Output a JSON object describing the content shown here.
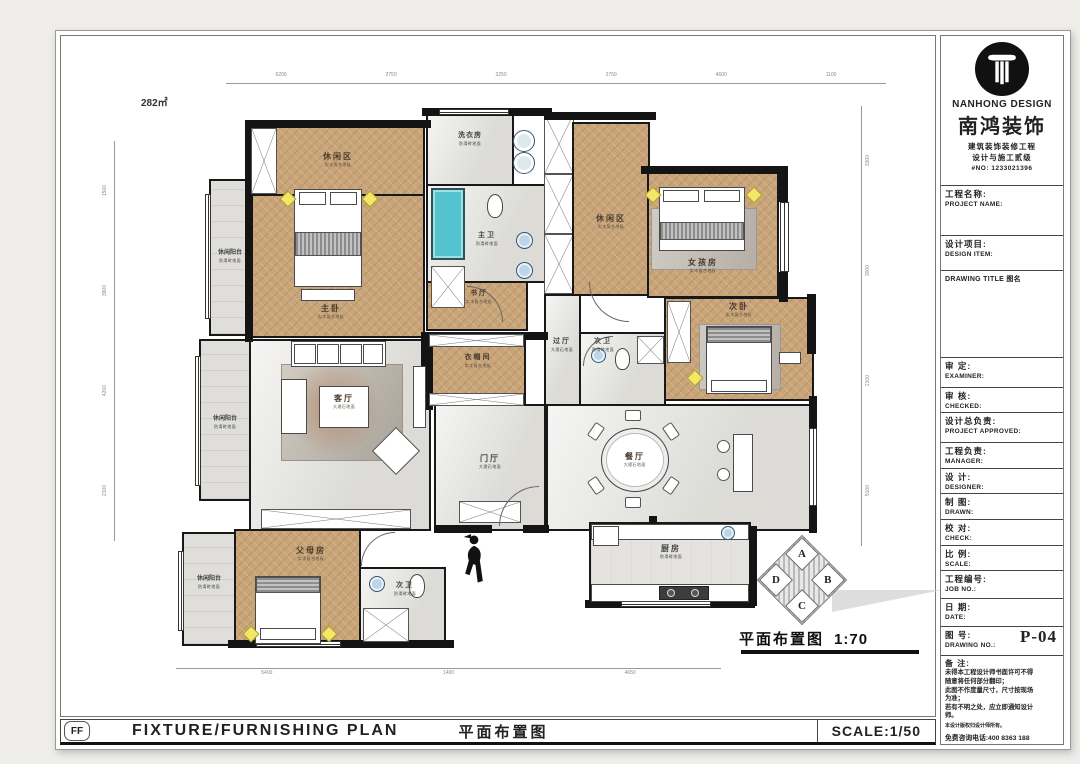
{
  "page": {
    "area_label": "282㎡",
    "caption": {
      "title": "平面布置图",
      "scale": "1:70"
    },
    "compass": {
      "top": "A",
      "right": "B",
      "bottom": "C",
      "left": "D"
    }
  },
  "rooms": {
    "leisure_tl": {
      "name": "休闲区",
      "sub": "实木复合地板"
    },
    "master": {
      "name": "主卧",
      "sub": "实木复合地板"
    },
    "balcony_tl": {
      "name": "休闲阳台",
      "sub": "防滑砖地面"
    },
    "laundry": {
      "name": "洗衣房",
      "sub": "防滑砖地面"
    },
    "master_bath": {
      "name": "主卫",
      "sub": "防滑砖地面"
    },
    "study_hall": {
      "name": "书厅",
      "sub": "实木复合地板"
    },
    "leisure_tr": {
      "name": "休闲区",
      "sub": "实木复合地板"
    },
    "girl": {
      "name": "女孩房",
      "sub": "实木复合地板"
    },
    "second": {
      "name": "次卧",
      "sub": "实木复合地板"
    },
    "bath_mid": {
      "name": "次卫",
      "sub": "防滑砖地面"
    },
    "hall": {
      "name": "过厅",
      "sub": "大理石地面"
    },
    "cloak": {
      "name": "衣帽间",
      "sub": "实木复合地板"
    },
    "living": {
      "name": "客厅",
      "sub": "大理石地面"
    },
    "balcony_ml": {
      "name": "休闲阳台",
      "sub": "防滑砖地面"
    },
    "foyer": {
      "name": "门厅",
      "sub": "大理石地面"
    },
    "dining": {
      "name": "餐厅",
      "sub": "大理石地面"
    },
    "parents": {
      "name": "父母房",
      "sub": "实木复合地板"
    },
    "balcony_bl": {
      "name": "休闲阳台",
      "sub": "防滑砖地面"
    },
    "bath_bottom": {
      "name": "次卫",
      "sub": "防滑砖地面"
    },
    "kitchen": {
      "name": "厨房",
      "sub": "防滑砖地面"
    }
  },
  "dims": {
    "top": [
      "6200",
      "2750",
      "3250",
      "2750",
      "4600",
      "1100"
    ],
    "left": [
      "1500",
      "3900",
      "4200",
      "2100"
    ],
    "right": [
      "3300",
      "3000",
      "2100",
      "5100"
    ],
    "bottom": [
      "5400",
      "1400",
      "4650"
    ]
  },
  "titleblock": {
    "logo": {
      "brand_en": "NANHONG DESIGN",
      "brand_cn": "南鸿装饰",
      "line1": "建筑装饰装修工程",
      "line2": "设计与施工贰级",
      "license": "#NO: 1233021396"
    },
    "rows": [
      {
        "cn": "工程名称:",
        "en": "PROJECT NAME:"
      },
      {
        "cn": "设计项目:",
        "en": "DESIGN ITEM:"
      },
      {
        "cn": "DRAWING TITLE 图名",
        "en": ""
      },
      {
        "cn": "审  定:",
        "en": "EXAMINER:"
      },
      {
        "cn": "审  核:",
        "en": "CHECKED:"
      },
      {
        "cn": "设计总负责:",
        "en": "PROJECT APPROVED:"
      },
      {
        "cn": "工程负责:",
        "en": "MANAGER:"
      },
      {
        "cn": "设  计:",
        "en": "DESIGNER:"
      },
      {
        "cn": "制  图:",
        "en": "DRAWN:"
      },
      {
        "cn": "校  对:",
        "en": "CHECK:"
      },
      {
        "cn": "比  例:",
        "en": "SCALE:"
      },
      {
        "cn": "工程编号:",
        "en": "JOB NO.:"
      },
      {
        "cn": "日  期:",
        "en": "DATE:"
      },
      {
        "cn": "图  号:",
        "en": "DRAWING NO.:",
        "value": "P-04"
      }
    ],
    "notes": {
      "title": "备  注:",
      "lines": [
        "未得本工程设计师书面许可不得",
        "随意将任何部分翻印；",
        "此图不作度量尺寸，尺寸按现场",
        "为准；",
        "若有不明之处，应立即通知设计",
        "师。"
      ],
      "copyright": "本设计版权归设计师所有。",
      "phone": "免费咨询电话:400 8363 188"
    }
  },
  "bottom_bar": {
    "code": "FF",
    "title_en": "FIXTURE/FURNISHING PLAN",
    "title_cn": "平面布置图",
    "scale": "SCALE:1/50"
  }
}
